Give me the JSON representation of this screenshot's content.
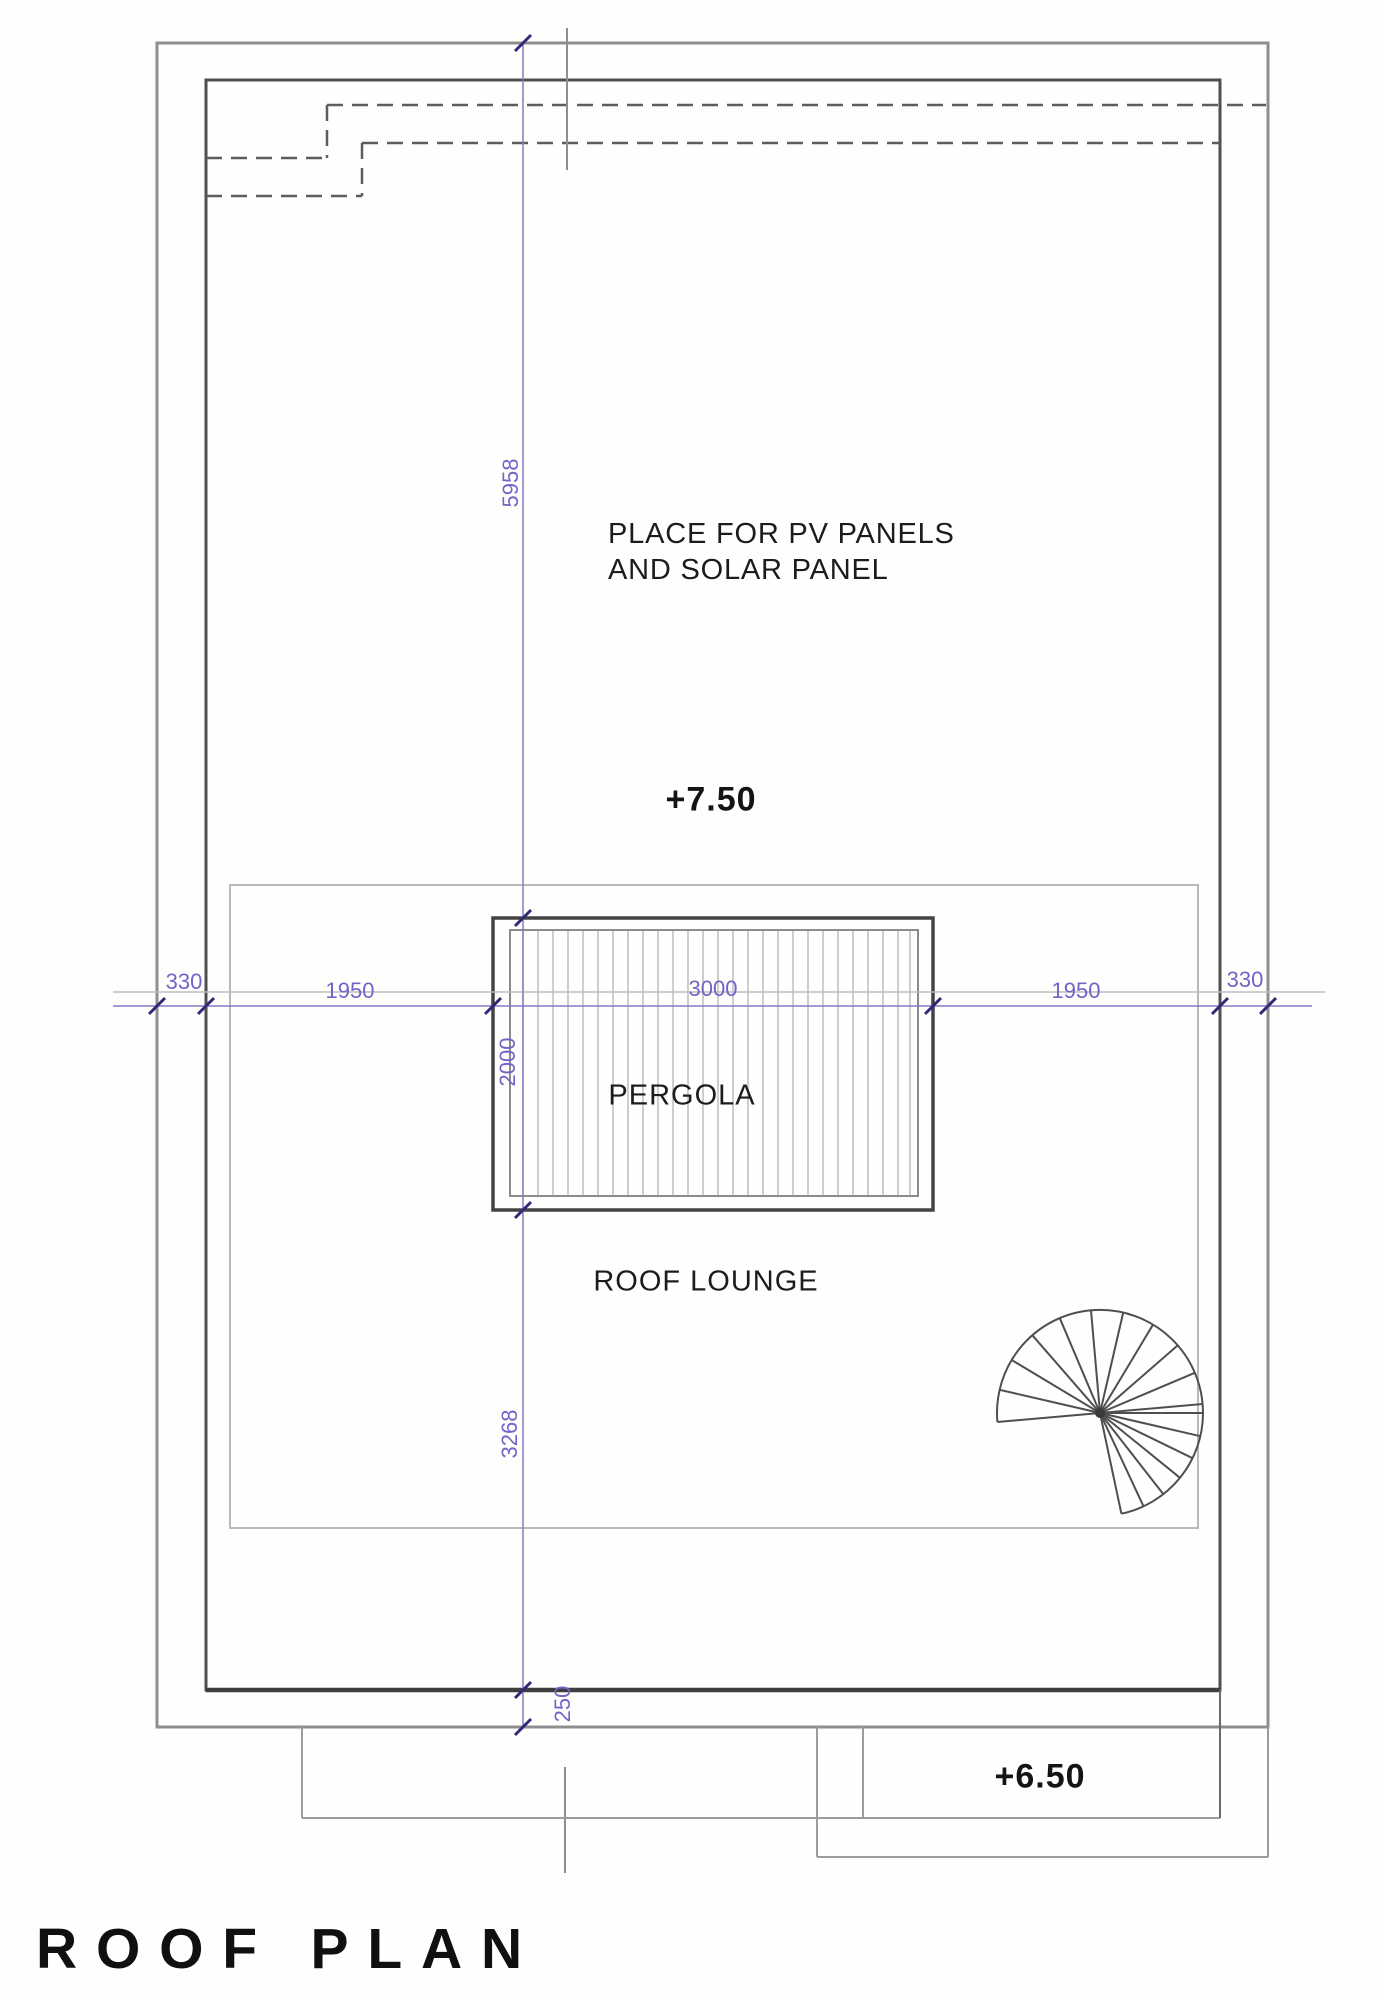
{
  "page": {
    "title": "ROOF PLAN"
  },
  "plan": {
    "area_labels": {
      "pv_line1": "PLACE FOR PV PANELS",
      "pv_line2": "AND SOLAR PANEL",
      "pergola": "PERGOLA",
      "roof_lounge": "ROOF LOUNGE"
    },
    "levels": {
      "roof_upper": "+7.50",
      "roof_lower": "+6.50"
    },
    "dimensions_mm": {
      "horizontal_chain": [
        "330",
        "1950",
        "3000",
        "1950",
        "330"
      ],
      "vertical_chain": [
        "5958",
        "2000",
        "3268",
        "250"
      ]
    },
    "colors": {
      "dimension_text": "#6f65c8",
      "dimension_line": "#837cc9",
      "dimension_tick": "#2f2a78",
      "wall_dark": "#4f4f4f",
      "wall_gray": "#8e8e8e",
      "platform_gray": "#b9b9b9",
      "text": "#1a1a1a"
    }
  }
}
